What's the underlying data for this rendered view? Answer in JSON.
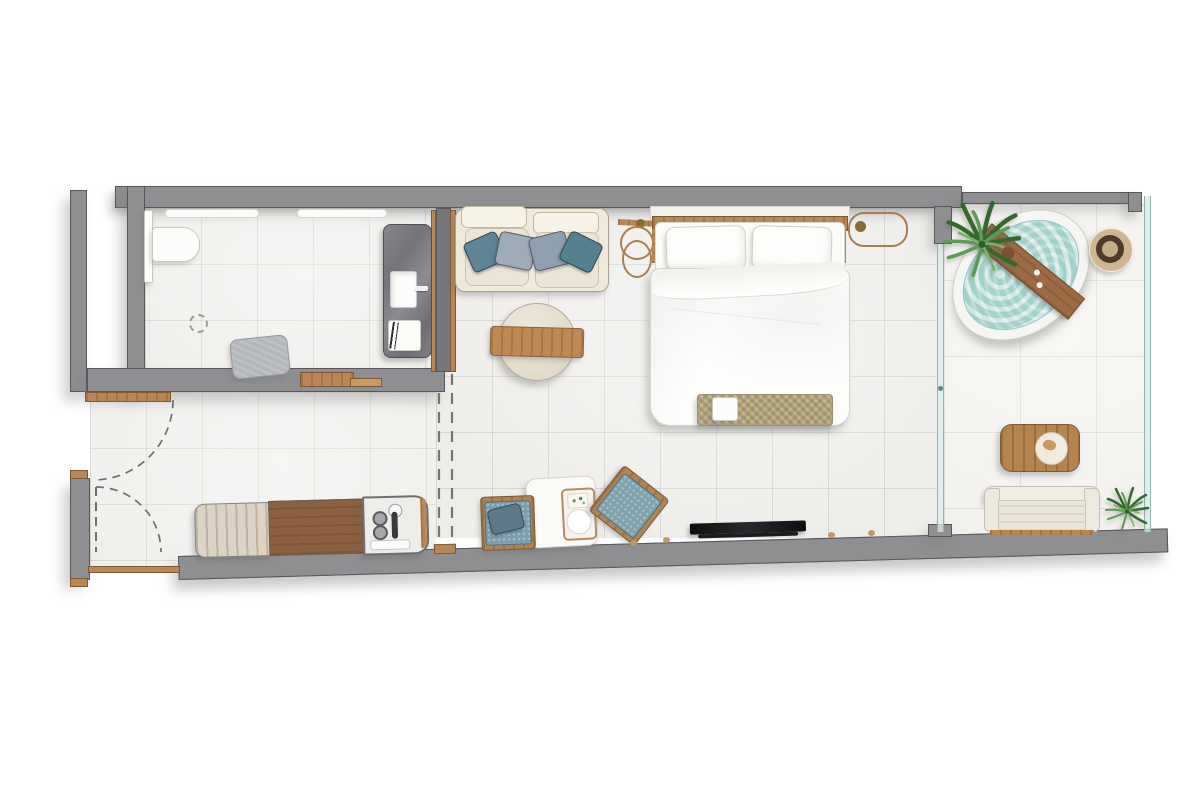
{
  "plan": {
    "type": "architectural-floor-plan",
    "view": "top-down",
    "title": "Studio Suite Floor Plan",
    "rooms": {
      "bathroom": {
        "label": "Bathroom",
        "items": [
          "toilet",
          "wall-niche",
          "wall-niche",
          "floor-drain",
          "bath-mat",
          "marble-vanity",
          "sink",
          "faucet",
          "towel-stack",
          "wood-sliding-door"
        ]
      },
      "entry": {
        "label": "Entry Hall / Kitchenette",
        "items": [
          "entry-door-swing",
          "interior-door-swing",
          "door-leaf",
          "wood-threshold",
          "kitchenette-cabinet",
          "kitchenette-worktop",
          "kitchenette-sink-unit",
          "hob-knobs",
          "kitchen-faucet"
        ]
      },
      "living": {
        "label": "Living / Bedroom",
        "items": [
          "sofa",
          "throw-pillow-teal",
          "throw-pillow-gray",
          "throw-pillow-gray",
          "throw-pillow-teal",
          "round-coffee-table",
          "wood-tray",
          "pendant-lamp",
          "pendant-lamp",
          "double-bed",
          "bed-pillow",
          "bed-pillow",
          "duvet",
          "woven-foot-bench",
          "dining-table",
          "serving-tray",
          "dining-chair",
          "dining-chair",
          "tv"
        ]
      },
      "balcony": {
        "label": "Balcony Terrace",
        "items": [
          "jacuzzi",
          "jacuzzi-wood-board",
          "fern-plant",
          "woven-bowl",
          "slatted-outdoor-table",
          "plate",
          "outdoor-sofa",
          "fern-plant-small",
          "glass-partition",
          "glass-railing"
        ]
      }
    },
    "palette": {
      "wall_gray": "#8f8f91",
      "wall_outline": "#57575b",
      "floor_tile": "#eeedea",
      "balcony_tile": "#f2f1ed",
      "wood_light": "#b98755",
      "wood_dark": "#8d6140",
      "cabinet_wood": "#ddd3c4",
      "marble_gray": "#7b7b7f",
      "water_teal": "#b9ded9",
      "upholstery_cream": "#efe9da",
      "pillow_teal": "#5e8495",
      "pillow_gray": "#9fabb9",
      "chair_blue": "#7c9dab",
      "bench_tan": "#c3b794",
      "plant_green": "#4d8748",
      "brass": "#a97f4f",
      "tv_black": "#141416",
      "glass_teal": "#8fb5ac"
    }
  }
}
